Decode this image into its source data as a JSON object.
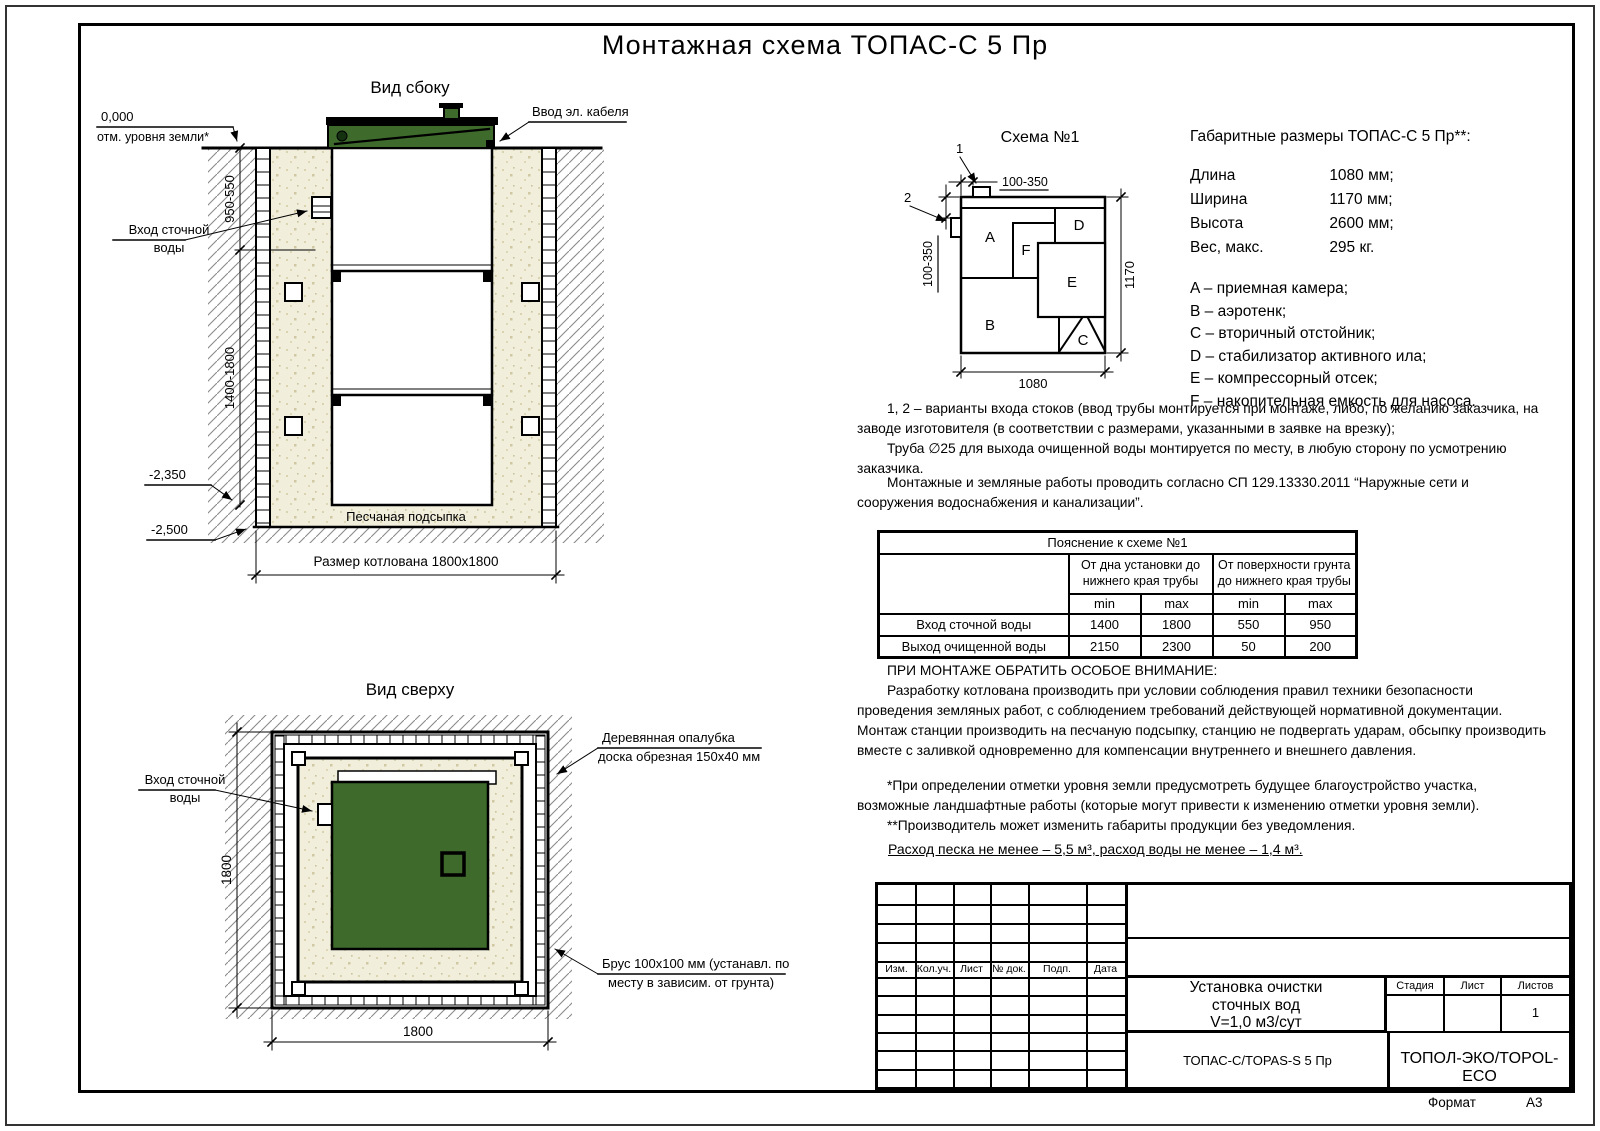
{
  "colors": {
    "tank_green": "#3e6b2c",
    "sand": "#f1eedc",
    "hatch_line": "#8a8a8a"
  },
  "title": "Монтажная схема ТОПАС-С 5 Пр",
  "side_view": {
    "label": "Вид сбоку",
    "zero_mark": "0,000",
    "zero_caption": "отм. уровня земли*",
    "cable_label": "Ввод эл. кабеля",
    "inlet_label_1": "Вход сточной",
    "inlet_label_2": "воды",
    "dim_top": "950-550",
    "dim_depth": "1400-1800",
    "mark_2350": "-2,350",
    "mark_2500": "-2,500",
    "sand_label": "Песчаная подсыпка",
    "pit_dim": "Размер котлована 1800х1800"
  },
  "top_view": {
    "label": "Вид сверху",
    "inlet_label_1": "Вход сточной",
    "inlet_label_2": "воды",
    "dim_v": "1800",
    "dim_h": "1800",
    "formwork_label_1": "Деревянная опалубка",
    "formwork_label_2": "доска обрезная 150х40 мм",
    "beam_label_1": "Брус 100х100 мм (устанавл. по",
    "beam_label_2": "месту в зависим. от грунта)"
  },
  "schema": {
    "label": "Схема №1",
    "marker_1": "1",
    "marker_2": "2",
    "dim_top": "100-350",
    "dim_left": "100-350",
    "dim_bottom": "1080",
    "dim_right": "1170",
    "compartments": {
      "a": "A",
      "b": "B",
      "c": "C",
      "d": "D",
      "e": "E",
      "f": "F"
    }
  },
  "gabarit": {
    "heading": "Габаритные размеры ТОПАС-С 5 Пр**:",
    "rows": [
      {
        "name": "Длина",
        "value": "1080 мм;"
      },
      {
        "name": "Ширина",
        "value": "1170 мм;"
      },
      {
        "name": "Высота",
        "value": "2600 мм;"
      },
      {
        "name": "Вес, макс.",
        "value": "295 кг."
      }
    ],
    "legend": [
      "A – приемная камера;",
      "B – аэротенк;",
      "C – вторичный отстойник;",
      "D – стабилизатор активного ила;",
      "E – компрессорный отсек;",
      "F – накопительная емкость для насоса."
    ]
  },
  "paragraphs": {
    "variants": "1, 2 – варианты входа  стоков (ввод трубы монтируется при монтаже, либо, по желанию заказчика, на заводе изготовителя (в соответствии с размерами, указанными в заявке на врезку);",
    "pipe": "Труба ∅25 для выхода очищенной воды монтируется по месту, в любую сторону по усмотрению заказчика.",
    "works": "Монтажные и земляные работы проводить согласно СП 129.13330.2011 “Наружные сети и сооружения водоснабжения и канализации”."
  },
  "explain_table": {
    "title": "Пояснение к схеме №1",
    "group1": "От дна установки до нижнего края трубы",
    "group2": "От поверхности грунта до нижнего края трубы",
    "min": "min",
    "max": "max",
    "rows": [
      {
        "name": "Вход сточной воды",
        "v1": "1400",
        "v2": "1800",
        "v3": "550",
        "v4": "950"
      },
      {
        "name": "Выход очищенной воды",
        "v1": "2150",
        "v2": "2300",
        "v3": "50",
        "v4": "200"
      }
    ]
  },
  "attention": {
    "heading": "ПРИ МОНТАЖЕ ОБРАТИТЬ ОСОБОЕ ВНИМАНИЕ:",
    "body": "Разработку котлована производить при условии соблюдения правил техники безопасности проведения земляных работ, с соблюдением требований действующей нормативной документации. Монтаж станции производить на песчаную подсыпку, станцию не подвергать ударам, обсыпку производить вместе с заливкой одновременно для компенсации внутреннего и внешнего давления."
  },
  "footnotes": {
    "note1": "*При определении отметки уровня земли предусмотреть будущее благоустройство участка, возможные ландшафтные работы (которые могут привести к изменению отметки уровня земли).",
    "note2": "**Производитель может изменить габариты продукции без уведомления."
  },
  "consumption": "Расход песка не менее – 5,5 м³, расход воды не менее – 1,4 м³.",
  "title_block": {
    "headers": [
      "Изм.",
      "Кол.уч.",
      "Лист",
      "№ док.",
      "Подп.",
      "Дата"
    ],
    "doc_title_1": "Установка очистки",
    "doc_title_2": "сточных вод",
    "doc_title_3": "V=1,0 м3/сут",
    "stage_label": "Стадия",
    "sheet_label": "Лист",
    "sheets_label": "Листов",
    "sheets_value": "1",
    "model": "ТОПАС-С/TOPAS-S 5 Пр",
    "brand": "ТОПОЛ-ЭКО/TOPOL-ECO"
  },
  "sheet_footer": {
    "format_label": "Формат",
    "format_value": "А3"
  }
}
